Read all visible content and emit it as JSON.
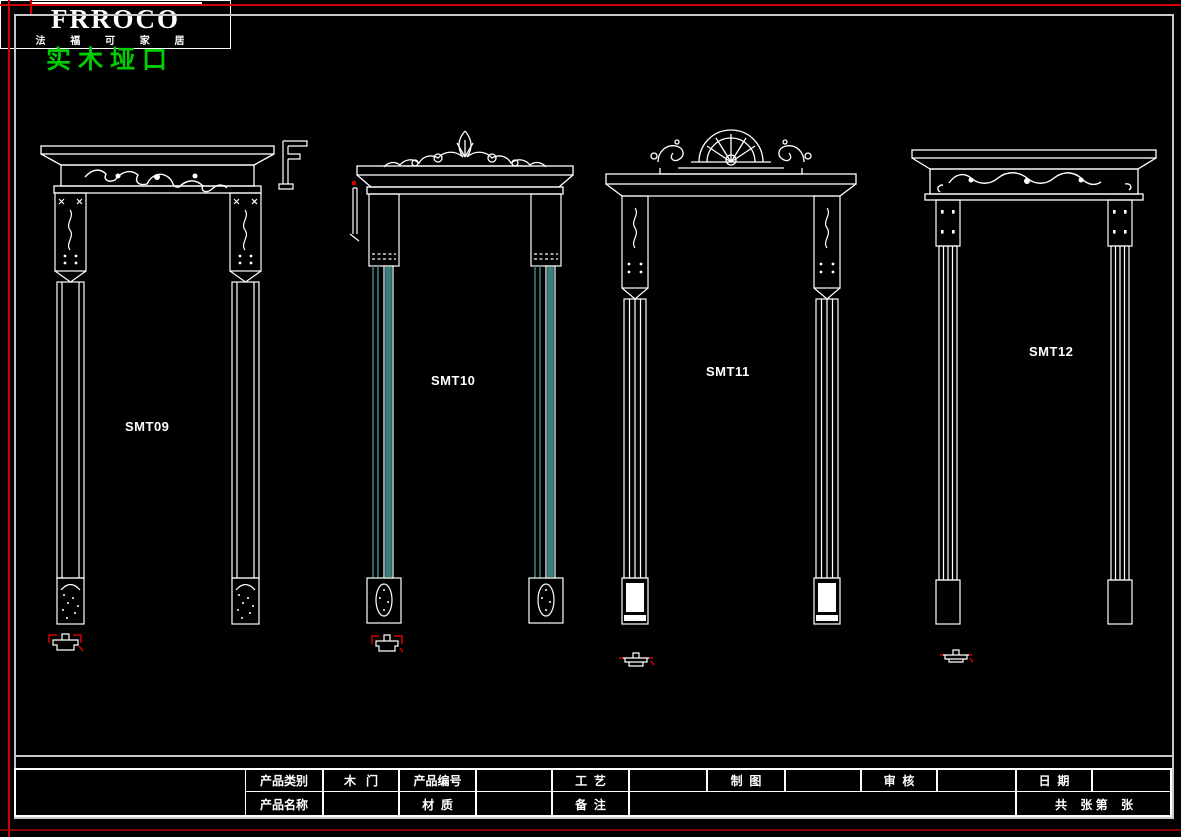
{
  "colors": {
    "background": "#000000",
    "frame-gray": "#c8c8c8",
    "red-accent": "#d40000",
    "red-dark": "#8b0000",
    "title-green": "#00cc00",
    "teal": "#377f7f"
  },
  "header": {
    "title": "实木垭口"
  },
  "frames": [
    {
      "label": "SMT09"
    },
    {
      "label": "SMT10"
    },
    {
      "label": "SMT11"
    },
    {
      "label": "SMT12"
    }
  ],
  "title_block": {
    "brand": "FRROCO",
    "brand_subtitle": "法 福 可 家 居",
    "row1": {
      "product_category_label": "产品类别",
      "product_category_value": "木   门",
      "product_code_label": "产品编号",
      "product_code_value": "",
      "craft_label": "工  艺",
      "craft_value": "",
      "drafting_label": "制  图",
      "drafting_value": "",
      "review_label": "审  核",
      "review_value": "",
      "date_label": "日  期",
      "date_value": ""
    },
    "row2": {
      "product_name_label": "产品名称",
      "product_name_value": "",
      "material_label": "材  质",
      "material_value": "",
      "remark_label": "备  注",
      "remark_value": "",
      "sheet_count_label": "共    张 第    张"
    }
  }
}
